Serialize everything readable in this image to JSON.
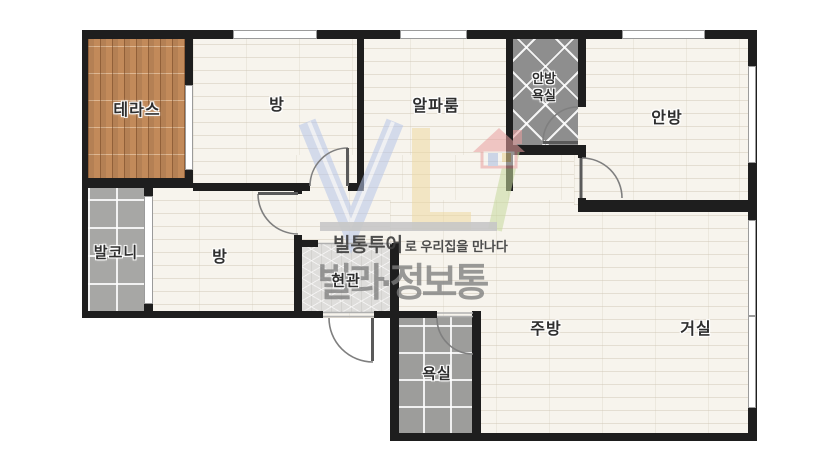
{
  "diagram_type": "apartment floor plan",
  "rooms": {
    "terrace": {
      "label": "테라스"
    },
    "room_top": {
      "label": "방"
    },
    "alpha_room": {
      "label": "알파룸"
    },
    "master_bathroom": {
      "label_line1": "안방",
      "label_line2": "욕실"
    },
    "master_bedroom": {
      "label": "안방"
    },
    "balcony": {
      "label": "발코니"
    },
    "room_middle": {
      "label": "방"
    },
    "entrance": {
      "label": "현관"
    },
    "bathroom": {
      "label": "욕실"
    },
    "kitchen": {
      "label": "주방"
    },
    "living_room": {
      "label": "거실"
    }
  },
  "watermark": {
    "logo": "VL-house-logo",
    "tagline_bold": "빌통투어",
    "tagline_rest": "로 우리집을 만나다",
    "brand": "빌라·정보통"
  },
  "palette": {
    "wall": "#1e1e1e",
    "floor": "#f7f4ed",
    "terrace_wood": "#c28a5a",
    "tile_gray": "#a7a7a5",
    "tile_dark": "#8e8e8e",
    "entry_gray": "#dedddb",
    "logo_blue": "#b7c6e9",
    "logo_yellow": "#eed9a1",
    "logo_green": "#c7da9e",
    "logo_red": "#e9a0a0",
    "watermark_gray": "#7d7d7d"
  }
}
